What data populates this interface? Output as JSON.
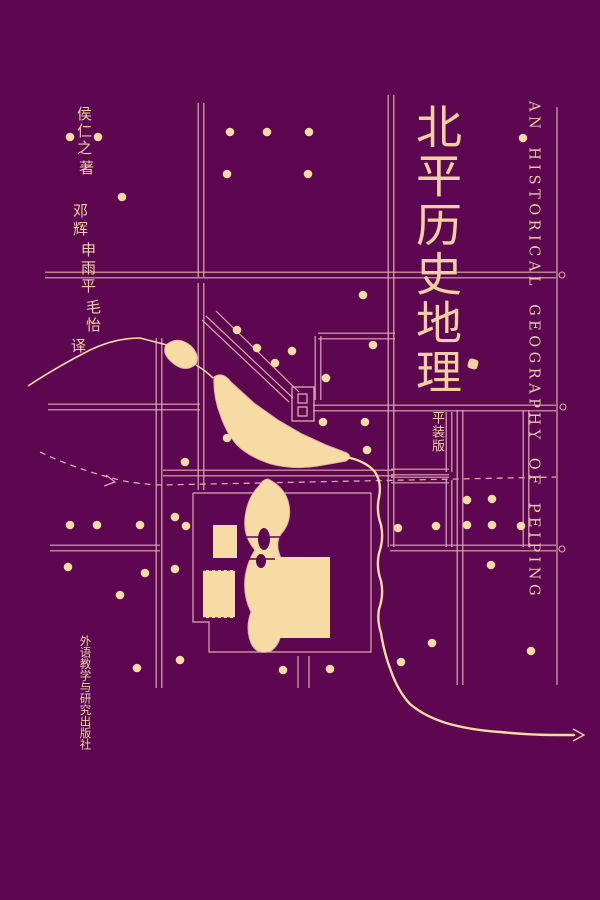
{
  "cover": {
    "title": "北平历史地理",
    "edition_label": "平装版",
    "author": "侯仁之",
    "author_role": "著",
    "translators": [
      "邓辉",
      "申雨平",
      "毛怡"
    ],
    "translator_role": "译",
    "publisher": "外语教学与研究出版社",
    "english_title": "AN HISTORICAL GEOGRAPHY OF PEIPING"
  },
  "colors": {
    "background": "#5C0750",
    "cream": "#F6DBA4",
    "line": "#DFA9AC",
    "lake_stroke": "#E2B3A4",
    "title_text": "#F2CFA2",
    "english_text": "#E9C9AC",
    "small_text": "#ECD2A6"
  },
  "map": {
    "double_streets": [
      [
        45,
        275,
        556,
        275
      ],
      [
        201,
        103,
        201,
        277
      ],
      [
        201,
        283,
        201,
        490
      ],
      [
        391,
        95,
        391,
        547
      ],
      [
        159,
        338,
        159,
        688
      ],
      [
        460,
        410,
        460,
        685
      ],
      [
        526,
        410,
        526,
        547
      ],
      [
        48,
        407,
        200,
        407
      ],
      [
        313,
        408,
        556,
        408
      ],
      [
        50,
        548,
        160,
        548
      ],
      [
        390,
        548,
        556,
        548
      ],
      [
        163,
        473,
        393,
        473
      ],
      [
        318,
        336,
        395,
        336
      ],
      [
        318,
        336,
        318,
        400
      ],
      [
        449,
        412,
        449,
        472
      ],
      [
        391,
        472,
        449,
        472
      ],
      [
        391,
        480,
        449,
        480
      ],
      [
        449,
        480,
        449,
        547
      ],
      [
        204,
        318,
        291,
        400
      ]
    ],
    "single_lines": [
      [
        557,
        107,
        557,
        685
      ],
      [
        216,
        311,
        299,
        392
      ],
      [
        298,
        656,
        298,
        688
      ],
      [
        309,
        656,
        309,
        688
      ]
    ],
    "imperial_wall": "M193,493 L371,493 L371,652 L209,652 L209,622 L193,622 L193,493",
    "stream": "M28,386 Q55,368 90,350 Q115,338 140,338 L167,345",
    "stream2": "M196,365 Q206,371 213,378",
    "upper_lake": "M166,345 Q178,335 191,346 Q200,355 196,364 Q186,373 174,364 Q161,354 166,345 Z",
    "big_lake": "M214,377 Q223,371 231,382 L254,403 L278,420 L302,434 L326,445 L347,453 Q353,457 346,461 L318,466 Q294,470 271,464 Q249,457 237,445 Q227,434 221,417 Q213,397 214,377 Z",
    "chain_lake": "M268,479 Q286,488 289,505 Q292,522 281,534 Q274,545 282,560 Q289,576 282,594 Q276,610 280,626 Q283,642 271,651 Q257,656 251,643 Q245,628 251,612 Q243,596 245,578 Q247,562 255,550 Q243,536 245,518 Q247,498 259,486 Q263,479 268,479 Z",
    "islands": [
      [
        264,
        539,
        6,
        11
      ],
      [
        261,
        561,
        5,
        7
      ]
    ],
    "bridges": [
      [
        246,
        537,
        288,
        537
      ],
      [
        248,
        559,
        284,
        559
      ]
    ],
    "rects": [
      [
        213,
        525,
        24,
        33
      ],
      [
        203,
        570,
        32,
        48
      ],
      [
        275,
        557,
        55,
        81
      ]
    ],
    "dashed_rect_index": 1,
    "gate": {
      "outer": [
        292,
        387,
        22,
        34
      ],
      "inner": [
        [
          298,
          394,
          9,
          9
        ],
        [
          298,
          407,
          9,
          9
        ]
      ]
    },
    "river": "M346,457 Q366,461 375,472 Q382,483 379,497 Q376,511 381,525 Q384,539 379,553 Q376,567 381,581 Q384,595 379,609 Q377,621 381,633 Q384,653 391,671 Q398,691 410,704 Q424,716 446,723 Q470,730 500,732 Q530,735 556,735 L574,735",
    "river_arrow": "M573,729 L584,735 L573,741",
    "dashed_line": "M40,452 Q80,471 124,481 Q140,484 160,485 L556,477",
    "dashed_arrow": "M106,475 L115,482 L104,486",
    "hooks": [
      [
        562,
        275
      ],
      [
        563,
        407
      ],
      [
        562,
        549
      ]
    ],
    "dots": [
      [
        70,
        137
      ],
      [
        98,
        137
      ],
      [
        122,
        197
      ],
      [
        230,
        132
      ],
      [
        267,
        132
      ],
      [
        309,
        132
      ],
      [
        227,
        174
      ],
      [
        308,
        174
      ],
      [
        523,
        138
      ],
      [
        363,
        295
      ],
      [
        373,
        345
      ],
      [
        237,
        330
      ],
      [
        257,
        348
      ],
      [
        292,
        351
      ],
      [
        275,
        363
      ],
      [
        326,
        378
      ],
      [
        227,
        438
      ],
      [
        185,
        462
      ],
      [
        323,
        422
      ],
      [
        365,
        422
      ],
      [
        367,
        450
      ],
      [
        70,
        525
      ],
      [
        97,
        525
      ],
      [
        140,
        525
      ],
      [
        175,
        517
      ],
      [
        186,
        526
      ],
      [
        68,
        567
      ],
      [
        145,
        573
      ],
      [
        175,
        569
      ],
      [
        120,
        595
      ],
      [
        398,
        528
      ],
      [
        436,
        526
      ],
      [
        467,
        500
      ],
      [
        492,
        499
      ],
      [
        467,
        525
      ],
      [
        492,
        525
      ],
      [
        521,
        526
      ],
      [
        491,
        565
      ],
      [
        137,
        668
      ],
      [
        180,
        660
      ],
      [
        283,
        670
      ],
      [
        330,
        669
      ],
      [
        401,
        662
      ],
      [
        432,
        643
      ],
      [
        531,
        651
      ]
    ],
    "dot_radius": 4.3
  }
}
